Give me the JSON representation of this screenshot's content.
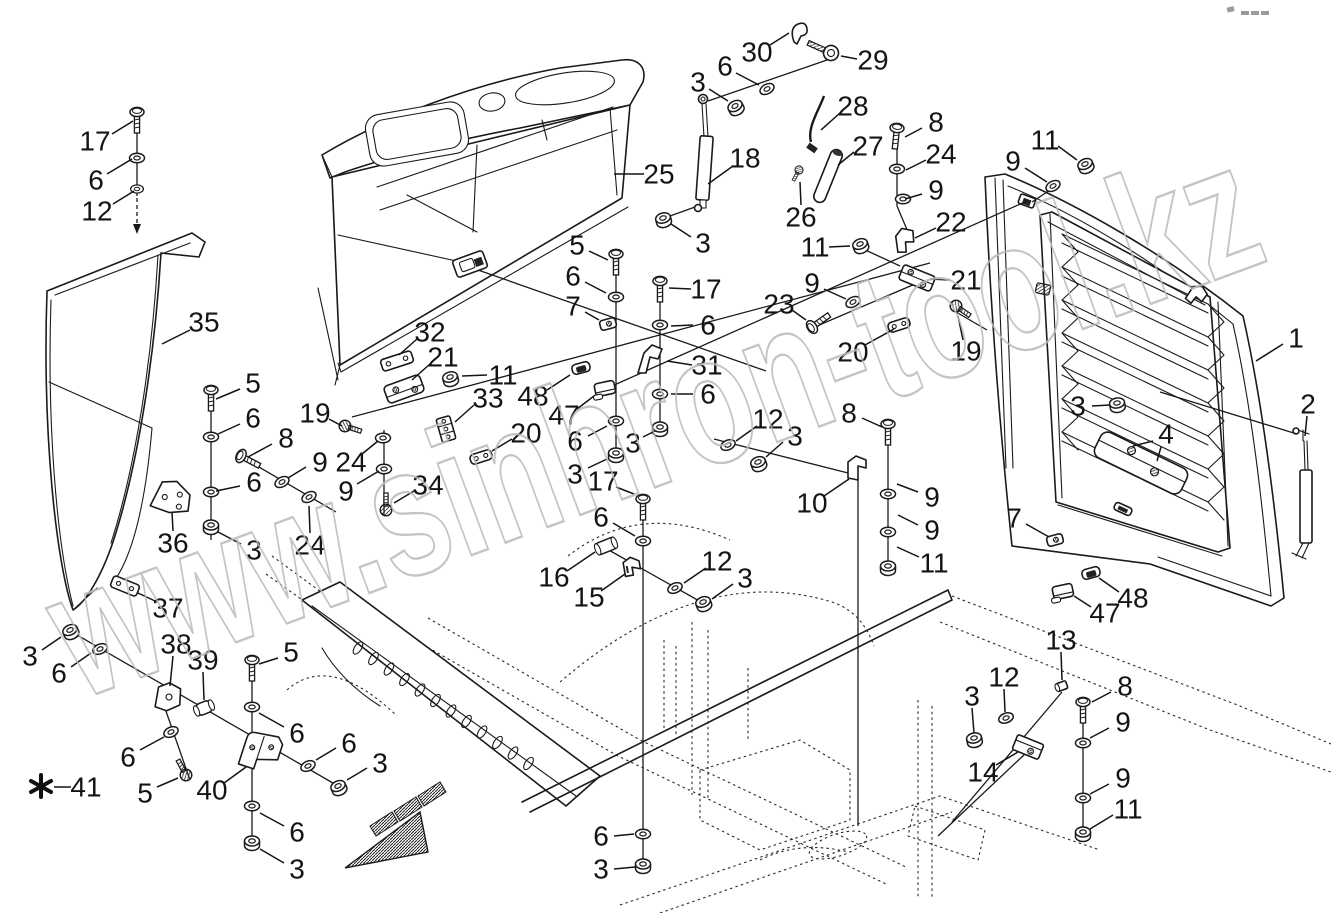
{
  "document": {
    "type": "exploded-parts-diagram",
    "subject": "hood, side panels and rear grille assembly with fasteners",
    "background_color": "#ffffff",
    "line_color": "#1a1a1a"
  },
  "watermark": {
    "text": "www.sinhron-tool.kz",
    "color": "#bababa"
  },
  "footnote": {
    "symbol": "*",
    "part_number": "41"
  },
  "part_numbers_shown": [
    1,
    2,
    3,
    4,
    5,
    6,
    7,
    8,
    9,
    10,
    11,
    12,
    13,
    14,
    15,
    16,
    17,
    18,
    19,
    20,
    21,
    22,
    23,
    24,
    25,
    26,
    27,
    28,
    29,
    30,
    31,
    32,
    33,
    34,
    35,
    36,
    37,
    38,
    39,
    40,
    41,
    47,
    48
  ],
  "callouts": [
    {
      "n": "17",
      "x": 95,
      "y": 141,
      "l": [
        [
          112,
          134,
          133,
          121
        ]
      ]
    },
    {
      "n": "6",
      "x": 96,
      "y": 180,
      "l": [
        [
          107,
          174,
          132,
          159
        ]
      ]
    },
    {
      "n": "12",
      "x": 97,
      "y": 211,
      "l": [
        [
          113,
          204,
          134,
          191
        ]
      ]
    },
    {
      "n": "35",
      "x": 204,
      "y": 322,
      "l": [
        [
          190,
          330,
          162,
          344
        ]
      ]
    },
    {
      "n": "5",
      "x": 253,
      "y": 383,
      "l": [
        [
          240,
          389,
          216,
          399
        ]
      ]
    },
    {
      "n": "6",
      "x": 253,
      "y": 418,
      "l": [
        [
          240,
          424,
          218,
          434
        ]
      ]
    },
    {
      "n": "8",
      "x": 286,
      "y": 438,
      "l": [
        [
          272,
          444,
          248,
          457
        ]
      ]
    },
    {
      "n": "9",
      "x": 320,
      "y": 462,
      "l": [
        [
          306,
          467,
          288,
          478
        ]
      ]
    },
    {
      "n": "19",
      "x": 315,
      "y": 413,
      "l": [
        [
          329,
          419,
          342,
          426
        ]
      ]
    },
    {
      "n": "24",
      "x": 351,
      "y": 462,
      "l": [
        [
          362,
          454,
          378,
          441
        ]
      ]
    },
    {
      "n": "9",
      "x": 346,
      "y": 491,
      "l": [
        [
          357,
          484,
          379,
          471
        ]
      ]
    },
    {
      "n": "24",
      "x": 310,
      "y": 545,
      "l": [
        [
          310,
          533,
          309,
          506
        ]
      ]
    },
    {
      "n": "36",
      "x": 173,
      "y": 543,
      "l": [
        [
          173,
          531,
          172,
          512
        ]
      ]
    },
    {
      "n": "6",
      "x": 254,
      "y": 482,
      "l": [
        [
          240,
          486,
          216,
          491
        ]
      ]
    },
    {
      "n": "3",
      "x": 254,
      "y": 550,
      "l": [
        [
          241,
          544,
          218,
          532
        ]
      ]
    },
    {
      "n": "32",
      "x": 430,
      "y": 332,
      "l": [
        [
          417,
          339,
          399,
          355
        ]
      ]
    },
    {
      "n": "21",
      "x": 443,
      "y": 357,
      "l": [
        [
          430,
          364,
          412,
          380
        ]
      ]
    },
    {
      "n": "11",
      "x": 503,
      "y": 375,
      "l": [
        [
          487,
          375,
          462,
          376
        ]
      ]
    },
    {
      "n": "33",
      "x": 488,
      "y": 398,
      "l": [
        [
          474,
          405,
          455,
          422
        ]
      ]
    },
    {
      "n": "20",
      "x": 526,
      "y": 433,
      "l": [
        [
          512,
          439,
          492,
          451
        ]
      ]
    },
    {
      "n": "34",
      "x": 428,
      "y": 485,
      "l": [
        [
          414,
          491,
          394,
          503
        ]
      ]
    },
    {
      "n": "25",
      "x": 659,
      "y": 174,
      "l": [
        [
          644,
          174,
          614,
          174
        ]
      ]
    },
    {
      "n": "18",
      "x": 745,
      "y": 158,
      "l": [
        [
          733,
          166,
          708,
          184
        ]
      ]
    },
    {
      "n": "30",
      "x": 757,
      "y": 52,
      "l": [
        [
          770,
          45,
          789,
          33
        ]
      ]
    },
    {
      "n": "29",
      "x": 873,
      "y": 60,
      "l": [
        [
          857,
          59,
          841,
          56
        ]
      ]
    },
    {
      "n": "6",
      "x": 725,
      "y": 66,
      "l": [
        [
          736,
          73,
          759,
          85
        ]
      ]
    },
    {
      "n": "3",
      "x": 698,
      "y": 82,
      "l": [
        [
          709,
          89,
          728,
          101
        ]
      ]
    },
    {
      "n": "28",
      "x": 853,
      "y": 106,
      "l": [
        [
          840,
          113,
          821,
          130
        ]
      ]
    },
    {
      "n": "27",
      "x": 868,
      "y": 146,
      "l": [
        [
          854,
          152,
          838,
          165
        ]
      ]
    },
    {
      "n": "26",
      "x": 801,
      "y": 217,
      "l": [
        [
          801,
          205,
          800,
          182
        ]
      ]
    },
    {
      "n": "3",
      "x": 703,
      "y": 243,
      "l": [
        [
          691,
          237,
          671,
          224
        ]
      ]
    },
    {
      "n": "11",
      "x": 815,
      "y": 247,
      "l": [
        [
          829,
          247,
          850,
          246
        ]
      ]
    },
    {
      "n": "9",
      "x": 812,
      "y": 283,
      "l": [
        [
          824,
          289,
          846,
          299
        ]
      ]
    },
    {
      "n": "23",
      "x": 779,
      "y": 304,
      "l": [
        [
          792,
          310,
          806,
          320
        ]
      ]
    },
    {
      "n": "22",
      "x": 951,
      "y": 222,
      "l": [
        [
          936,
          228,
          915,
          238
        ]
      ]
    },
    {
      "n": "21",
      "x": 966,
      "y": 280,
      "l": [
        [
          950,
          280,
          930,
          279
        ]
      ]
    },
    {
      "n": "20",
      "x": 853,
      "y": 352,
      "l": [
        [
          865,
          345,
          894,
          329
        ]
      ]
    },
    {
      "n": "19",
      "x": 966,
      "y": 351,
      "l": [
        [
          963,
          340,
          958,
          316
        ]
      ]
    },
    {
      "n": "12",
      "x": 768,
      "y": 419,
      "l": [
        [
          757,
          426,
          736,
          441
        ]
      ]
    },
    {
      "n": "3",
      "x": 795,
      "y": 436,
      "l": [
        [
          783,
          442,
          766,
          457
        ]
      ]
    },
    {
      "n": "10",
      "x": 812,
      "y": 503,
      "l": [
        [
          824,
          496,
          849,
          479
        ]
      ]
    },
    {
      "n": "8",
      "x": 849,
      "y": 413,
      "l": [
        [
          862,
          418,
          882,
          427
        ]
      ]
    },
    {
      "n": "9",
      "x": 932,
      "y": 497,
      "l": [
        [
          918,
          492,
          897,
          484
        ]
      ]
    },
    {
      "n": "9",
      "x": 932,
      "y": 530,
      "l": [
        [
          918,
          525,
          898,
          515
        ]
      ]
    },
    {
      "n": "11",
      "x": 934,
      "y": 563,
      "l": [
        [
          919,
          557,
          897,
          547
        ]
      ]
    },
    {
      "n": "8",
      "x": 936,
      "y": 122,
      "l": [
        [
          922,
          128,
          905,
          137
        ]
      ]
    },
    {
      "n": "24",
      "x": 941,
      "y": 154,
      "l": [
        [
          926,
          160,
          906,
          170
        ]
      ]
    },
    {
      "n": "9",
      "x": 936,
      "y": 190,
      "l": [
        [
          922,
          194,
          905,
          199
        ]
      ]
    },
    {
      "n": "11",
      "x": 1045,
      "y": 140,
      "l": [
        [
          1058,
          146,
          1077,
          160
        ]
      ]
    },
    {
      "n": "9",
      "x": 1013,
      "y": 161,
      "l": [
        [
          1025,
          168,
          1047,
          182
        ]
      ]
    },
    {
      "n": "1",
      "x": 1296,
      "y": 338,
      "l": [
        [
          1283,
          344,
          1256,
          361
        ]
      ]
    },
    {
      "n": "2",
      "x": 1308,
      "y": 404,
      "l": [
        [
          1307,
          416,
          1305,
          436
        ]
      ]
    },
    {
      "n": "3",
      "x": 1078,
      "y": 406,
      "l": [
        [
          1092,
          406,
          1110,
          405
        ]
      ]
    },
    {
      "n": "4",
      "x": 1166,
      "y": 434,
      "l": [
        [
          1153,
          441,
          1133,
          446
        ],
        [
          1161,
          447,
          1157,
          461
        ]
      ]
    },
    {
      "n": "7",
      "x": 1014,
      "y": 518,
      "l": [
        [
          1026,
          524,
          1049,
          537
        ]
      ]
    },
    {
      "n": "48",
      "x": 1133,
      "y": 598,
      "l": [
        [
          1119,
          592,
          1099,
          578
        ]
      ]
    },
    {
      "n": "47",
      "x": 1105,
      "y": 613,
      "l": [
        [
          1091,
          607,
          1074,
          596
        ]
      ]
    },
    {
      "n": "13",
      "x": 1061,
      "y": 640,
      "l": [
        [
          1061,
          652,
          1062,
          680
        ]
      ]
    },
    {
      "n": "12",
      "x": 1004,
      "y": 677,
      "l": [
        [
          1004,
          689,
          1005,
          712
        ]
      ]
    },
    {
      "n": "3",
      "x": 972,
      "y": 696,
      "l": [
        [
          972,
          708,
          974,
          733
        ]
      ]
    },
    {
      "n": "14",
      "x": 983,
      "y": 772,
      "l": [
        [
          996,
          765,
          1018,
          752
        ]
      ]
    },
    {
      "n": "8",
      "x": 1125,
      "y": 686,
      "l": [
        [
          1111,
          692,
          1092,
          702
        ]
      ]
    },
    {
      "n": "9",
      "x": 1123,
      "y": 722,
      "l": [
        [
          1109,
          728,
          1090,
          738
        ]
      ]
    },
    {
      "n": "9",
      "x": 1123,
      "y": 778,
      "l": [
        [
          1109,
          784,
          1090,
          794
        ]
      ]
    },
    {
      "n": "11",
      "x": 1128,
      "y": 809,
      "l": [
        [
          1113,
          815,
          1090,
          829
        ]
      ]
    },
    {
      "n": "5",
      "x": 577,
      "y": 245,
      "l": [
        [
          589,
          251,
          608,
          260
        ]
      ]
    },
    {
      "n": "6",
      "x": 573,
      "y": 276,
      "l": [
        [
          585,
          282,
          606,
          293
        ]
      ]
    },
    {
      "n": "7",
      "x": 573,
      "y": 306,
      "l": [
        [
          585,
          312,
          599,
          320
        ]
      ]
    },
    {
      "n": "48",
      "x": 533,
      "y": 396,
      "l": [
        [
          547,
          390,
          570,
          375
        ]
      ]
    },
    {
      "n": "47",
      "x": 564,
      "y": 415,
      "l": [
        [
          577,
          409,
          594,
          396
        ]
      ]
    },
    {
      "n": "6",
      "x": 575,
      "y": 441,
      "l": [
        [
          588,
          436,
          607,
          426
        ]
      ]
    },
    {
      "n": "3",
      "x": 575,
      "y": 474,
      "l": [
        [
          588,
          468,
          607,
          459
        ]
      ]
    },
    {
      "n": "17",
      "x": 706,
      "y": 289,
      "l": [
        [
          691,
          289,
          669,
          288
        ]
      ]
    },
    {
      "n": "6",
      "x": 708,
      "y": 325,
      "l": [
        [
          693,
          325,
          671,
          326
        ]
      ]
    },
    {
      "n": "31",
      "x": 707,
      "y": 365,
      "l": [
        [
          692,
          365,
          667,
          361
        ]
      ]
    },
    {
      "n": "6",
      "x": 708,
      "y": 394,
      "l": [
        [
          693,
          394,
          671,
          394
        ]
      ]
    },
    {
      "n": "3",
      "x": 633,
      "y": 443,
      "l": [
        [
          643,
          437,
          655,
          431
        ]
      ]
    },
    {
      "n": "17",
      "x": 603,
      "y": 481,
      "l": [
        [
          616,
          487,
          634,
          494
        ]
      ]
    },
    {
      "n": "6",
      "x": 601,
      "y": 517,
      "l": [
        [
          613,
          523,
          635,
          536
        ]
      ]
    },
    {
      "n": "16",
      "x": 554,
      "y": 577,
      "l": [
        [
          567,
          571,
          595,
          552
        ]
      ]
    },
    {
      "n": "15",
      "x": 589,
      "y": 597,
      "l": [
        [
          601,
          591,
          625,
          574
        ]
      ]
    },
    {
      "n": "12",
      "x": 717,
      "y": 561,
      "l": [
        [
          706,
          568,
          684,
          583
        ]
      ]
    },
    {
      "n": "3",
      "x": 745,
      "y": 578,
      "l": [
        [
          733,
          584,
          712,
          599
        ]
      ]
    },
    {
      "n": "6",
      "x": 601,
      "y": 836,
      "l": [
        [
          614,
          836,
          634,
          834
        ]
      ]
    },
    {
      "n": "3",
      "x": 601,
      "y": 869,
      "l": [
        [
          614,
          869,
          635,
          867
        ]
      ]
    },
    {
      "n": "37",
      "x": 168,
      "y": 608,
      "l": [
        [
          155,
          601,
          138,
          593
        ]
      ]
    },
    {
      "n": "3",
      "x": 30,
      "y": 656,
      "l": [
        [
          42,
          650,
          61,
          637
        ]
      ]
    },
    {
      "n": "6",
      "x": 59,
      "y": 673,
      "l": [
        [
          71,
          667,
          91,
          653
        ]
      ]
    },
    {
      "n": "38",
      "x": 176,
      "y": 644,
      "l": [
        [
          173,
          656,
          170,
          686
        ]
      ]
    },
    {
      "n": "39",
      "x": 203,
      "y": 660,
      "l": [
        [
          203,
          672,
          204,
          700
        ]
      ]
    },
    {
      "n": "5",
      "x": 291,
      "y": 652,
      "l": [
        [
          278,
          658,
          259,
          664
        ]
      ]
    },
    {
      "n": "6",
      "x": 297,
      "y": 733,
      "l": [
        [
          284,
          727,
          259,
          713
        ]
      ]
    },
    {
      "n": "6",
      "x": 128,
      "y": 757,
      "l": [
        [
          140,
          750,
          164,
          737
        ]
      ]
    },
    {
      "n": "5",
      "x": 145,
      "y": 793,
      "l": [
        [
          157,
          787,
          178,
          778
        ]
      ]
    },
    {
      "n": "40",
      "x": 212,
      "y": 790,
      "l": [
        [
          224,
          783,
          246,
          767
        ]
      ]
    },
    {
      "n": "6",
      "x": 349,
      "y": 743,
      "l": [
        [
          336,
          748,
          316,
          760
        ]
      ]
    },
    {
      "n": "3",
      "x": 380,
      "y": 763,
      "l": [
        [
          367,
          768,
          347,
          780
        ]
      ]
    },
    {
      "n": "6",
      "x": 297,
      "y": 832,
      "l": [
        [
          284,
          826,
          260,
          813
        ]
      ]
    },
    {
      "n": "3",
      "x": 297,
      "y": 869,
      "l": [
        [
          284,
          863,
          260,
          849
        ]
      ]
    },
    {
      "n": "41",
      "x": 86,
      "y": 787,
      "l": [
        [
          71,
          787,
          54,
          787
        ]
      ]
    }
  ]
}
